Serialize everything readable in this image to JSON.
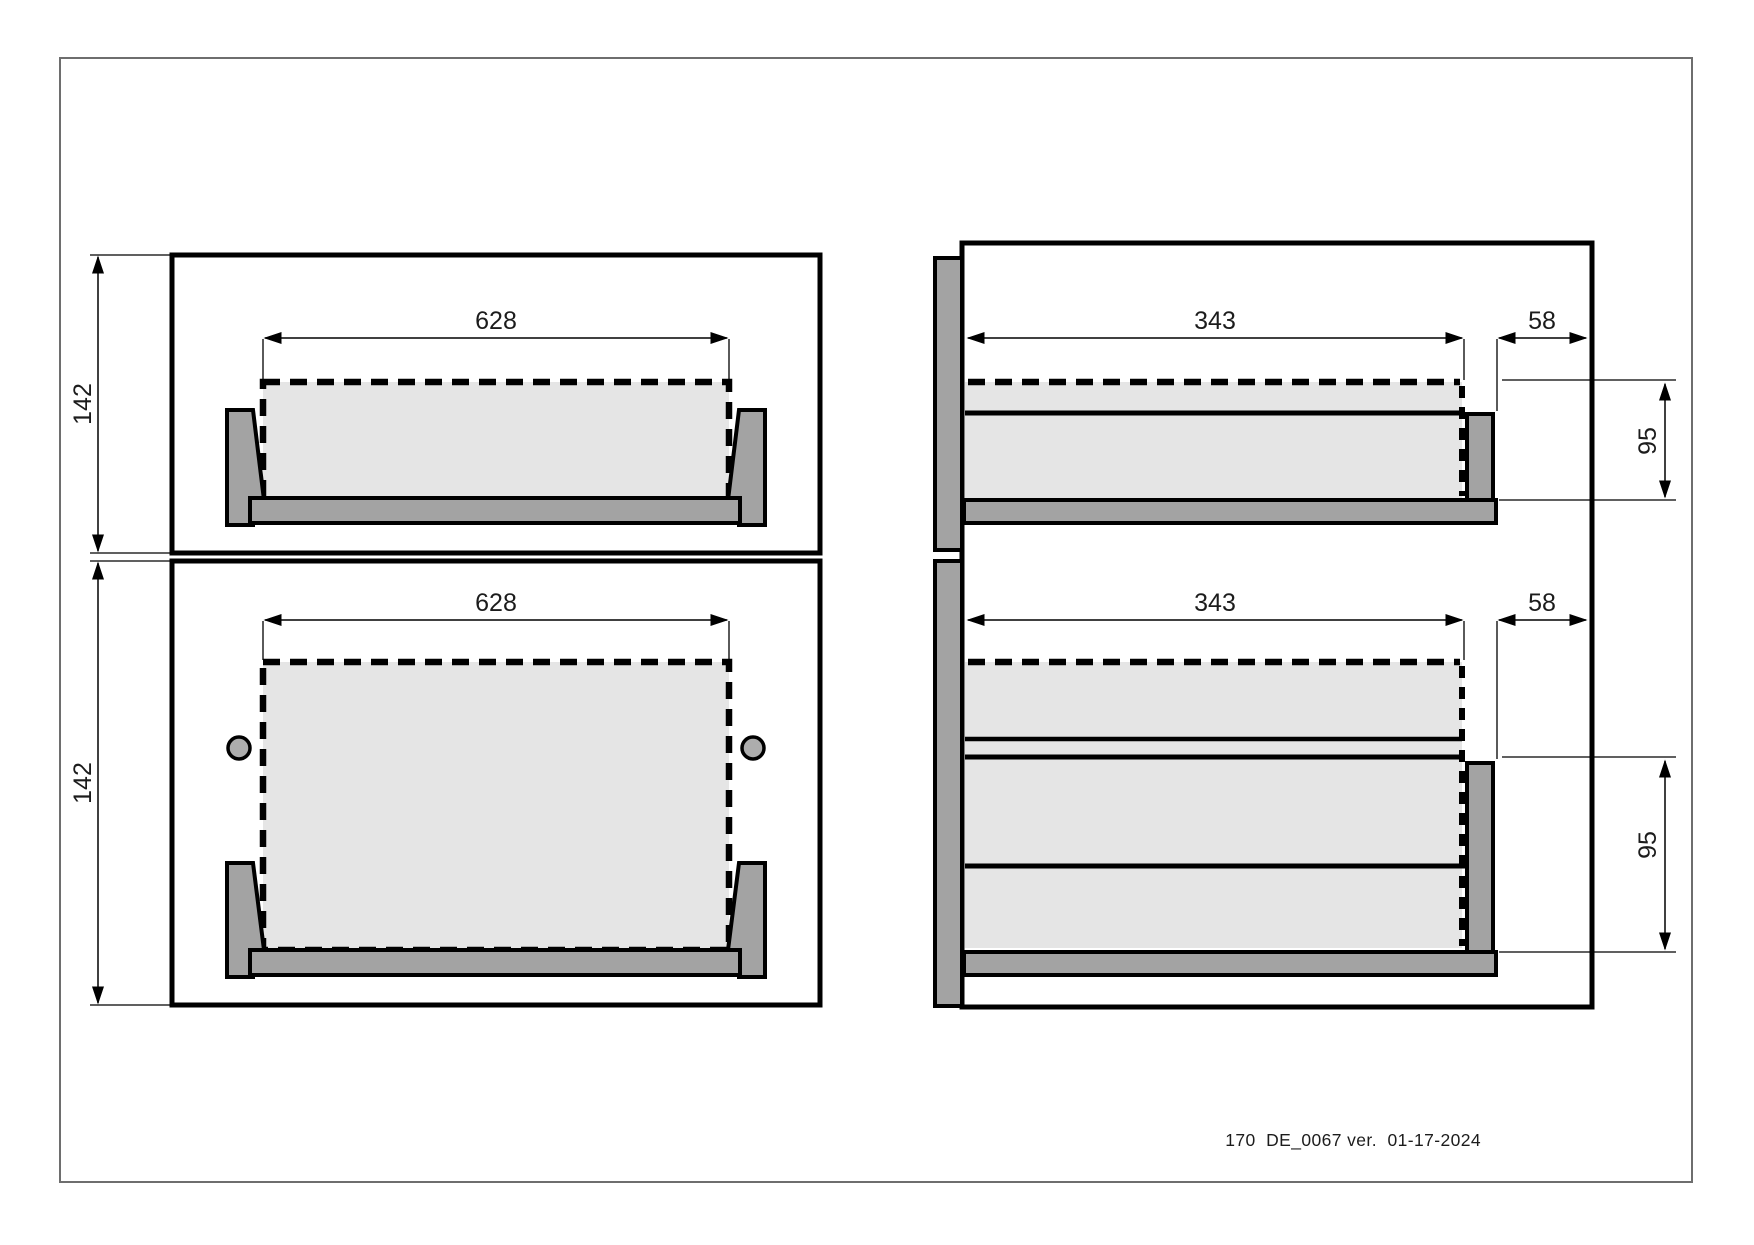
{
  "sheet": {
    "footer": {
      "text": "170  DE_0067 ver.  01-17-2024"
    },
    "colors": {
      "panel_fill": "#e5e5e5",
      "part_fill": "#a3a3a3",
      "hole_fill": "#adadad",
      "outline": "#000000",
      "border": "#6e6e6e"
    },
    "views": {
      "front_top": {
        "width": "628",
        "height": "142"
      },
      "front_bottom": {
        "width": "628",
        "height": "142"
      },
      "side_top": {
        "depth": "343",
        "offset": "58",
        "back_height": "95"
      },
      "side_bottom": {
        "depth": "343",
        "offset": "58",
        "back_height": "95"
      }
    }
  }
}
